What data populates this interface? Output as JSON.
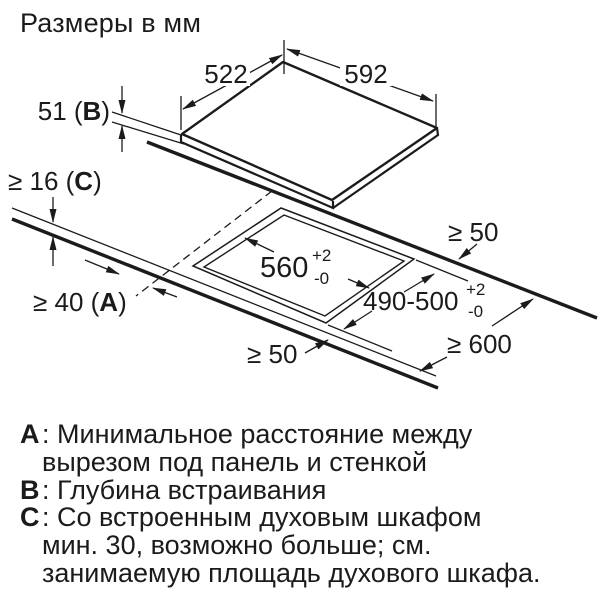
{
  "title": "Размеры в мм",
  "colors": {
    "ink": "#1b1b1b",
    "background": "#ffffff"
  },
  "diagram": {
    "hob_width": "592",
    "hob_depth": "522",
    "embed_depth": {
      "pre": "51 (",
      "letter": "B",
      "post": ")"
    },
    "worktop_thickness": {
      "pre": "≥ 16 (",
      "letter": "C",
      "post": ")"
    },
    "side_clearance": {
      "pre": "≥ 40 (",
      "letter": "A",
      "post": ")"
    },
    "cutout_width": {
      "value": "560",
      "tol_plus": "+2",
      "tol_minus": "-0"
    },
    "cutout_depth": {
      "value": "490-500",
      "tol_plus": "+2",
      "tol_minus": "-0"
    },
    "rear_clearance": "≥ 50",
    "front_clearance": "≥ 50",
    "worktop_depth": "≥ 600"
  },
  "legend": [
    {
      "letter": "A",
      "text": ": Минимальное расстояние между"
    },
    {
      "letter": "",
      "text": "вырезом под панель и стенкой"
    },
    {
      "letter": "B",
      "text": ": Глубина встраивания"
    },
    {
      "letter": "C",
      "text": ": Со встроенным духовым шкафом"
    },
    {
      "letter": "",
      "text": "мин. 30, возможно больше; см."
    },
    {
      "letter": "",
      "text": "занимаемую площадь духового шкафа."
    }
  ]
}
